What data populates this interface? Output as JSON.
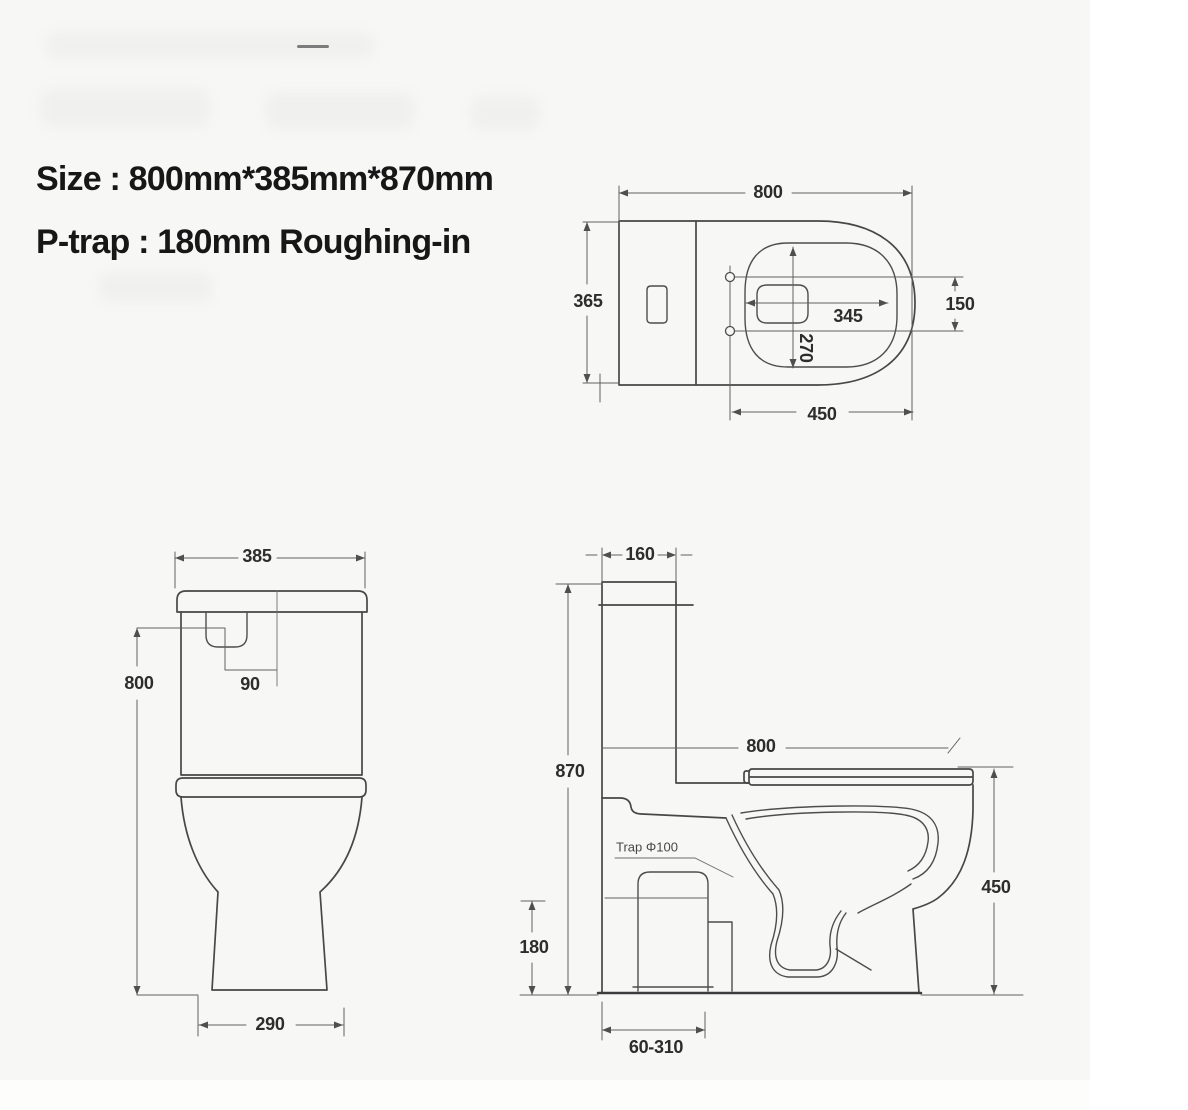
{
  "colors": {
    "background": "#f7f7f6",
    "panel_white": "#ffffff",
    "line": "#474747",
    "dim_line": "#606060",
    "label_text": "#2d2d2d",
    "title_text": "#171717"
  },
  "title": {
    "line1": "Size : 800mm*385mm*870mm",
    "line2": "P-trap : 180mm Roughing-in"
  },
  "top_view": {
    "dim_overall_length": "800",
    "dim_overall_width": "365",
    "dim_seat_width": "345",
    "dim_hinge_spacing": "150",
    "dim_seat_depth": "270",
    "dim_bowl_length": "450"
  },
  "front_view": {
    "dim_width": "385",
    "dim_height": "800",
    "dim_button_offset": "90",
    "dim_base_width": "290"
  },
  "side_view": {
    "dim_tank_depth": "160",
    "dim_total_height": "870",
    "dim_length": "800",
    "dim_rim_height": "450",
    "dim_trap_height": "180",
    "dim_roughin_range": "60-310",
    "trap_label": "Trap Φ100"
  }
}
